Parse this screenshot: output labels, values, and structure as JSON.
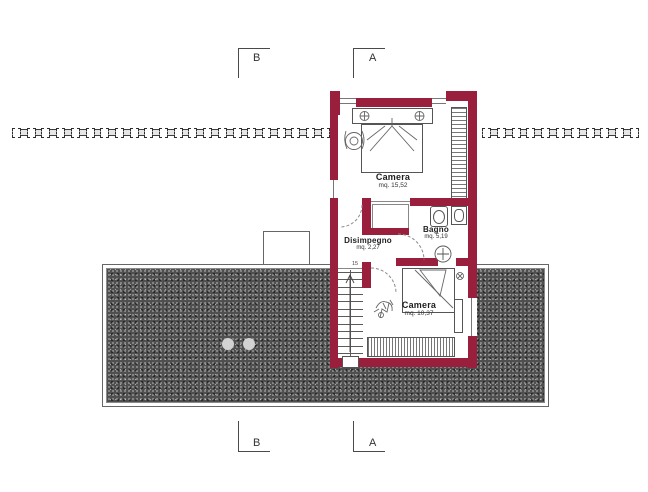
{
  "markers": {
    "top_left": "B",
    "top_right": "A",
    "bottom_left": "B",
    "bottom_right": "A"
  },
  "rooms": {
    "camera_top": {
      "name": "Camera",
      "area": "mq. 15,52"
    },
    "bagno": {
      "name": "Bagno",
      "area": "mq. 5,19"
    },
    "disimpegno": {
      "name": "Disimpegno",
      "area": "mq. 2,27"
    },
    "camera_bottom": {
      "name": "Camera",
      "area": "mq. 10,37"
    }
  },
  "stairs": {
    "top_step_label": "15",
    "tread_count": 12
  },
  "beams": {
    "left_count": 22,
    "right_count": 11
  },
  "terrace": {
    "skylight_count": 2
  },
  "colors": {
    "wall": "#9a1f3d",
    "terrace_fill": "#4f4f4f",
    "line": "#555555"
  }
}
